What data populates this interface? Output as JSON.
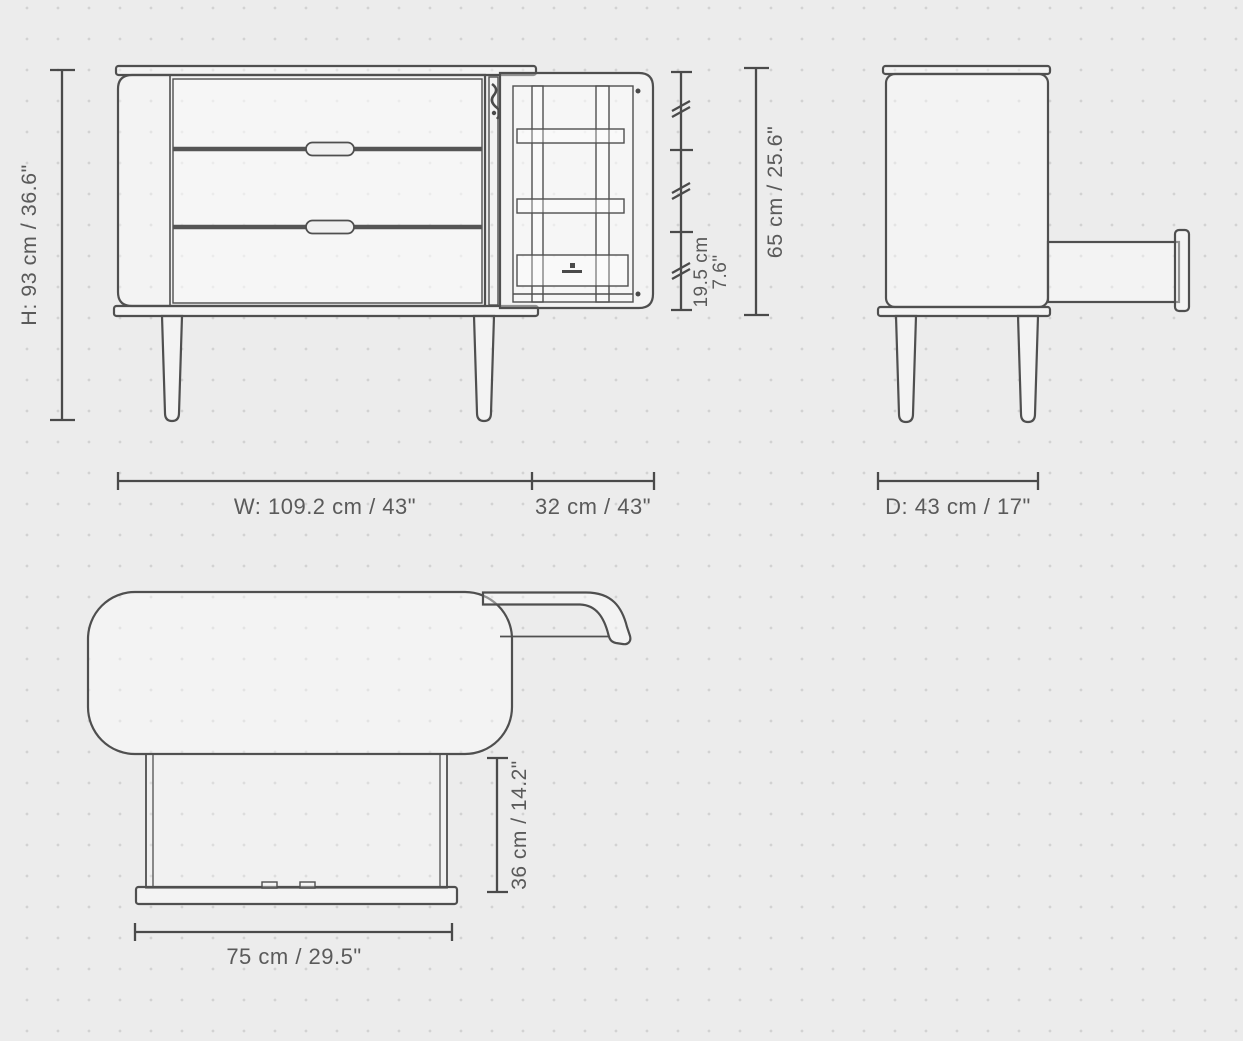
{
  "page": {
    "type": "furniture-dimension-diagram",
    "background_color": "#ececec",
    "dot_grid_color": "#d2d2d2",
    "line_color": "#4f4f4f",
    "text_color": "#5a5a5a"
  },
  "dimensions": {
    "height": "H: 93 cm / 36.6\"",
    "shelf_spacing_cm": "19.5 cm",
    "shelf_spacing_in": "7.6\"",
    "interior_height": "65 cm / 25.6\"",
    "width": "W: 109.2 cm / 43\"",
    "door_open_width": "32 cm / 43\"",
    "depth": "D: 43 cm / 17\"",
    "drawer_extension": "36 cm / 14.2\"",
    "drawer_width": "75 cm / 29.5\""
  }
}
